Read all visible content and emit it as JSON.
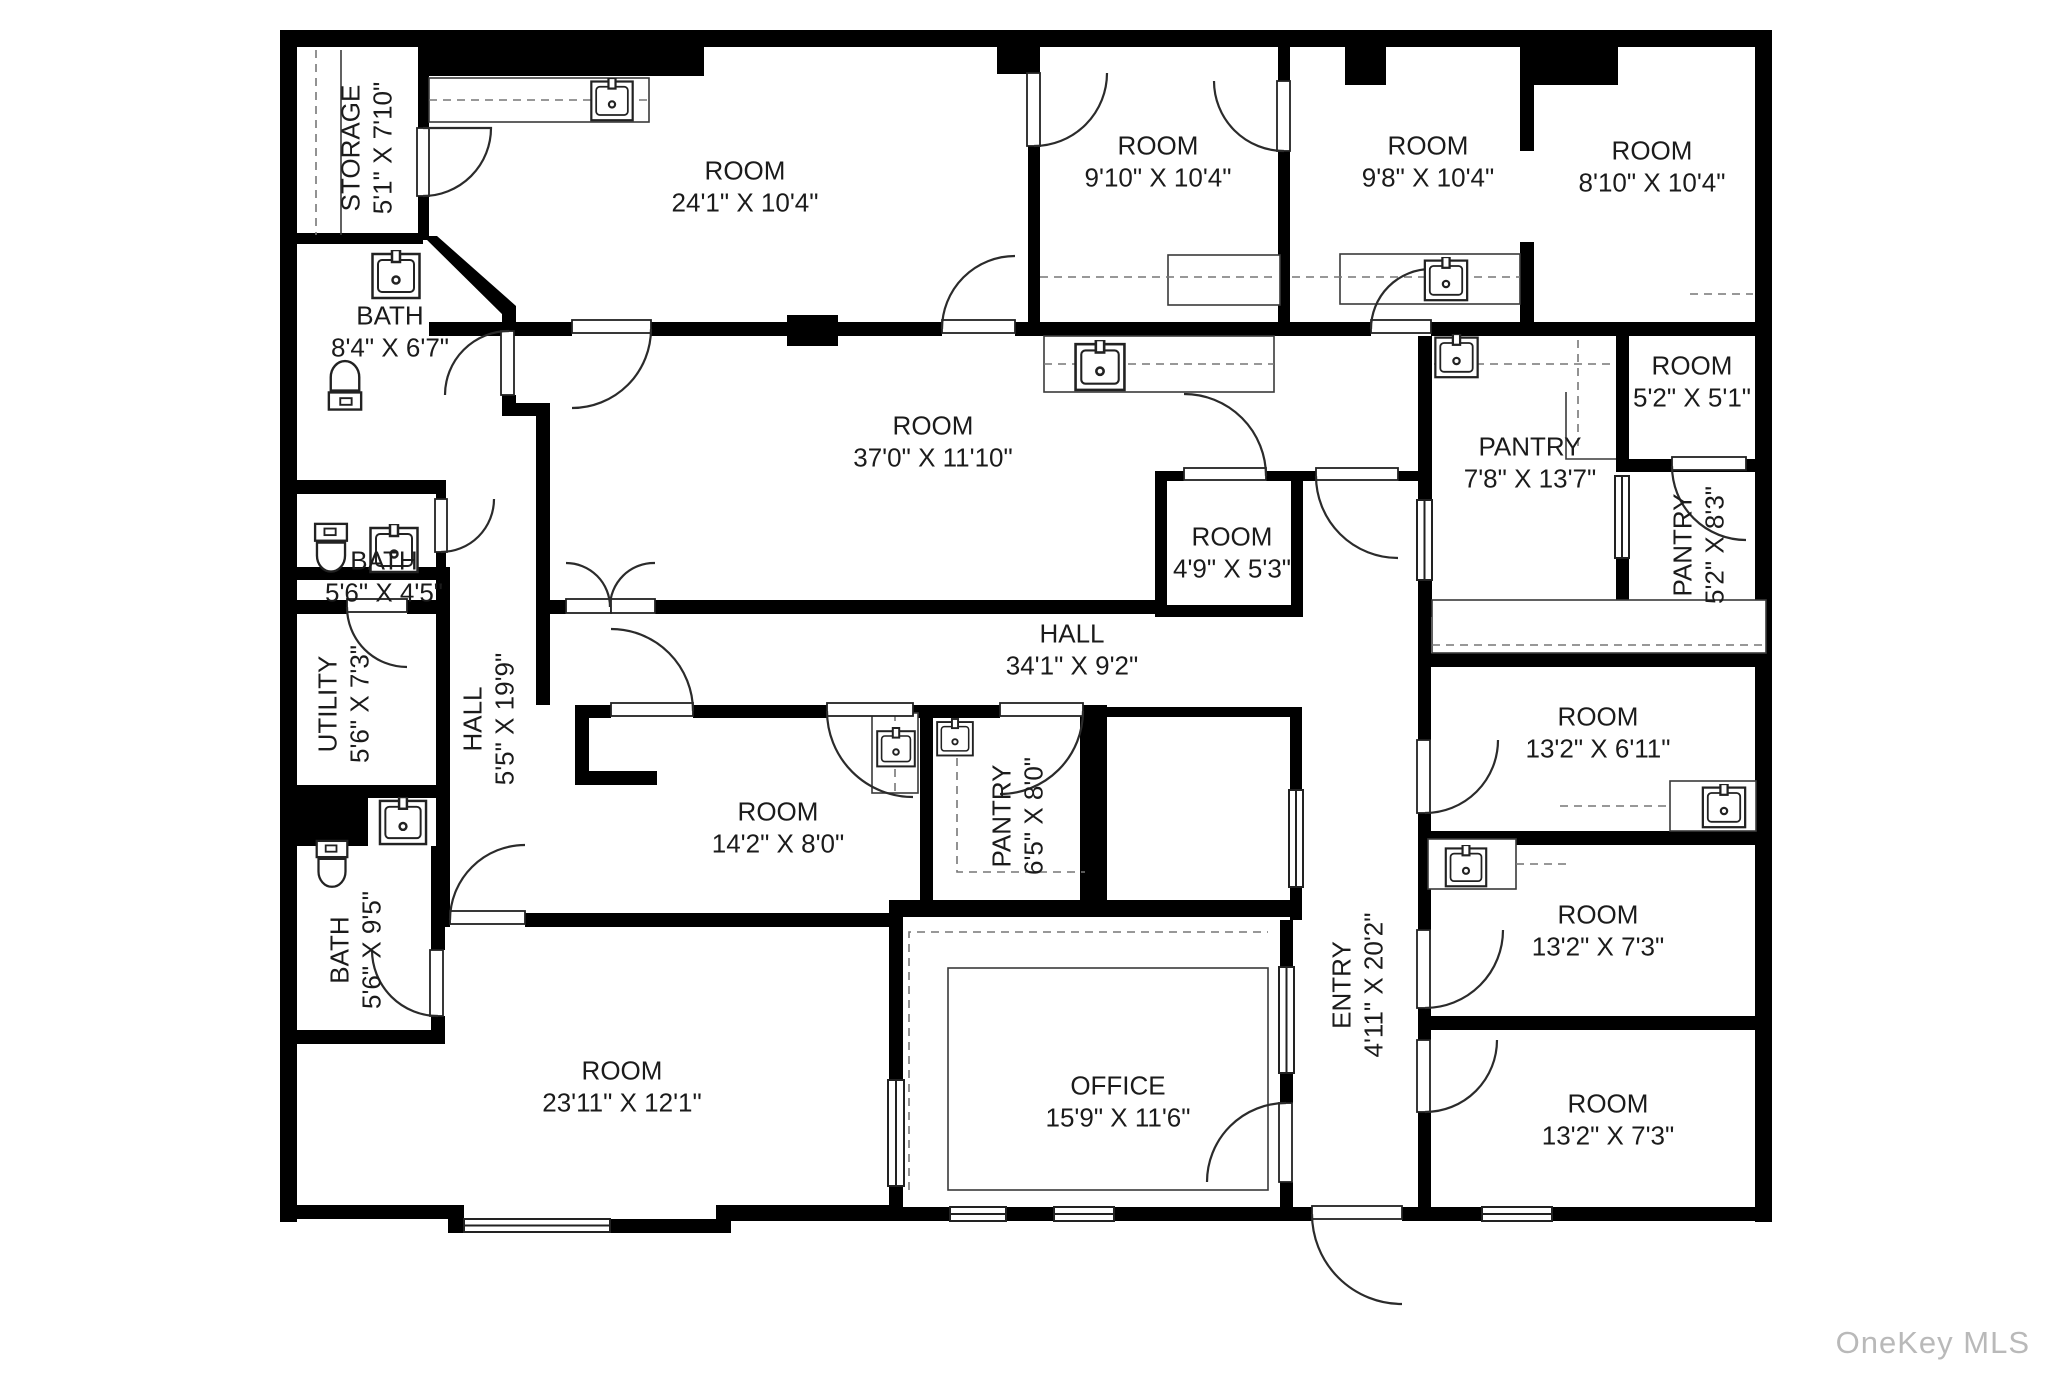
{
  "watermark": "OneKey MLS",
  "colors": {
    "wall": "#000000",
    "line": "#3a3a3a",
    "dash": "#777777",
    "label": "#1b1b1b",
    "watermark": "#b9b9b9",
    "background": "#ffffff"
  },
  "icons": {
    "sink-icon": "square basin with faucet",
    "toilet-icon": "tank and bowl",
    "door-icon": "quarter-circle swing arc",
    "window-icon": "double-line wall opening"
  },
  "rooms": [
    {
      "name": "STORAGE",
      "dims": "5'1\" X 7'10\"",
      "x": 367,
      "y": 148,
      "rotate": true
    },
    {
      "name": "ROOM",
      "dims": "24'1\" X 10'4\"",
      "x": 745,
      "y": 187,
      "rotate": false
    },
    {
      "name": "ROOM",
      "dims": "9'10\" X 10'4\"",
      "x": 1158,
      "y": 162,
      "rotate": false
    },
    {
      "name": "ROOM",
      "dims": "9'8\" X 10'4\"",
      "x": 1428,
      "y": 162,
      "rotate": false
    },
    {
      "name": "ROOM",
      "dims": "8'10\" X 10'4\"",
      "x": 1652,
      "y": 167,
      "rotate": false
    },
    {
      "name": "BATH",
      "dims": "8'4\" X 6'7\"",
      "x": 390,
      "y": 332,
      "rotate": false
    },
    {
      "name": "ROOM",
      "dims": "37'0\" X 11'10\"",
      "x": 933,
      "y": 442,
      "rotate": false
    },
    {
      "name": "ROOM",
      "dims": "5'2\" X 5'1\"",
      "x": 1692,
      "y": 382,
      "rotate": false
    },
    {
      "name": "PANTRY",
      "dims": "7'8\" X 13'7\"",
      "x": 1530,
      "y": 463,
      "rotate": false
    },
    {
      "name": "PANTRY",
      "dims": "5'2\" X 8'3\"",
      "x": 1699,
      "y": 545,
      "rotate": true
    },
    {
      "name": "BATH",
      "dims": "5'6\" X 4'5\"",
      "x": 384,
      "y": 577,
      "rotate": false
    },
    {
      "name": "ROOM",
      "dims": "4'9\" X 5'3\"",
      "x": 1232,
      "y": 553,
      "rotate": false
    },
    {
      "name": "HALL",
      "dims": "34'1\" X 9'2\"",
      "x": 1072,
      "y": 650,
      "rotate": false
    },
    {
      "name": "UTILITY",
      "dims": "5'6\" X 7'3\"",
      "x": 344,
      "y": 704,
      "rotate": true
    },
    {
      "name": "HALL",
      "dims": "5'5\" X 19'9\"",
      "x": 489,
      "y": 719,
      "rotate": true
    },
    {
      "name": "ROOM",
      "dims": "13'2\" X 6'11\"",
      "x": 1598,
      "y": 733,
      "rotate": false
    },
    {
      "name": "ROOM",
      "dims": "14'2\" X 8'0\"",
      "x": 778,
      "y": 828,
      "rotate": false
    },
    {
      "name": "PANTRY",
      "dims": "6'5\" X 8'0\"",
      "x": 1018,
      "y": 816,
      "rotate": true
    },
    {
      "name": "BATH",
      "dims": "5'6\" X 9'5\"",
      "x": 356,
      "y": 950,
      "rotate": true
    },
    {
      "name": "ROOM",
      "dims": "13'2\" X 7'3\"",
      "x": 1598,
      "y": 931,
      "rotate": false
    },
    {
      "name": "ENTRY",
      "dims": "4'11\" X 20'2\"",
      "x": 1358,
      "y": 985,
      "rotate": true
    },
    {
      "name": "ROOM",
      "dims": "23'11\" X 12'1\"",
      "x": 622,
      "y": 1087,
      "rotate": false
    },
    {
      "name": "OFFICE",
      "dims": "15'9\" X 11'6\"",
      "x": 1118,
      "y": 1102,
      "rotate": false
    },
    {
      "name": "ROOM",
      "dims": "13'2\" X 7'3\"",
      "x": 1608,
      "y": 1120,
      "rotate": false
    }
  ]
}
